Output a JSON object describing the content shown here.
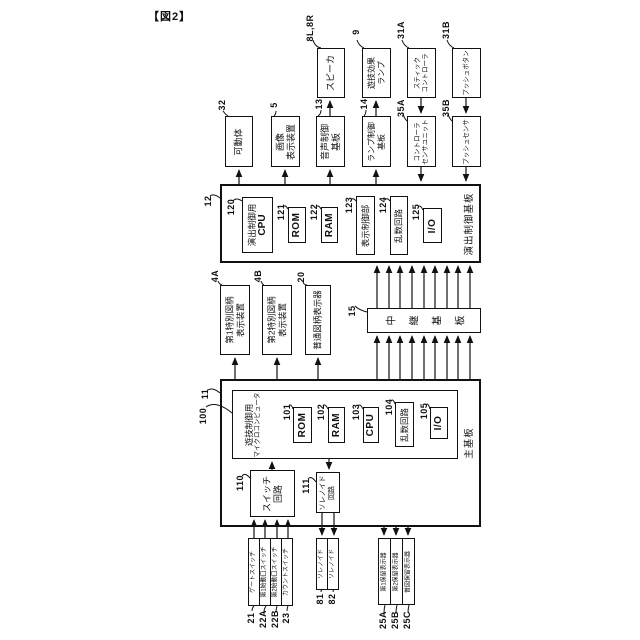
{
  "title": "【図2】",
  "colors": {
    "line": "#111111",
    "background": "#ffffff"
  },
  "blocks": {
    "speaker": {
      "ref": "8L,8R",
      "label": "スピーカ"
    },
    "effect_lamp": {
      "ref": "9",
      "label": "遊技効果\nランプ"
    },
    "stick_controller": {
      "ref": "31A",
      "label": "スティック\nコントローラ"
    },
    "push_button": {
      "ref": "31B",
      "label": "プッシュボタン"
    },
    "movable_body": {
      "ref": "32",
      "label": "可動体"
    },
    "image_display": {
      "ref": "5",
      "label": "画像\n表示装置"
    },
    "sound_board": {
      "ref": "13",
      "label": "音声制御\n基板"
    },
    "lamp_board": {
      "ref": "14",
      "label": "ランプ制御\n基板"
    },
    "controller_sensor": {
      "ref": "35A",
      "label": "コントローラ\nセンサユニット"
    },
    "push_sensor": {
      "ref": "35B",
      "label": "プッシュセンサ"
    },
    "effect_board": {
      "ref": "12",
      "label": "演出制御基板"
    },
    "effect_cpu": {
      "ref": "120",
      "label1": "演出制御用",
      "label2": "CPU"
    },
    "rom121": {
      "ref": "121",
      "label": "ROM"
    },
    "ram122": {
      "ref": "122",
      "label": "RAM"
    },
    "display_ctrl": {
      "ref": "123",
      "label": "表示制御部"
    },
    "random124": {
      "ref": "124",
      "label": "乱数回路"
    },
    "io125": {
      "ref": "125",
      "label": "I/O"
    },
    "special1_display": {
      "ref": "4A",
      "label": "第1特別図柄\n表示装置"
    },
    "special2_display": {
      "ref": "4B",
      "label": "第2特別図柄\n表示装置"
    },
    "normal_display": {
      "ref": "20",
      "label": "普通図柄表示器"
    },
    "relay_board": {
      "ref": "15",
      "label": "中継基板"
    },
    "main_board": {
      "ref": "11",
      "label": "主基板"
    },
    "game_micom": {
      "ref": "100",
      "label1": "遊技制御用",
      "label2": "マイクロコンピュータ"
    },
    "rom101": {
      "ref": "101",
      "label": "ROM"
    },
    "ram102": {
      "ref": "102",
      "label": "RAM"
    },
    "cpu103": {
      "ref": "103",
      "label": "CPU"
    },
    "random104": {
      "ref": "104",
      "label": "乱数回路"
    },
    "io105": {
      "ref": "105",
      "label": "I/O"
    },
    "switch_circuit": {
      "ref": "110",
      "label": "スイッチ\n回路"
    },
    "solenoid_circuit": {
      "ref": "111",
      "label": "ソレノイド\n回路"
    },
    "gate_switch": {
      "ref": "21",
      "label": "ゲートスイッチ"
    },
    "start1_switch": {
      "ref": "22A",
      "label": "第1始動口スイッチ"
    },
    "start2_switch": {
      "ref": "22B",
      "label": "第2始動口スイッチ"
    },
    "count_switch": {
      "ref": "23",
      "label": "カウントスイッチ"
    },
    "solenoid81": {
      "ref": "81",
      "label": "ソレノイド"
    },
    "solenoid82": {
      "ref": "82",
      "label": "ソレノイド"
    },
    "hold1_display": {
      "ref": "25A",
      "label": "第1保留表示器"
    },
    "hold2_display": {
      "ref": "25B",
      "label": "第2保留表示器"
    },
    "holdn_display": {
      "ref": "25C",
      "label": "普図保留表示器"
    }
  }
}
